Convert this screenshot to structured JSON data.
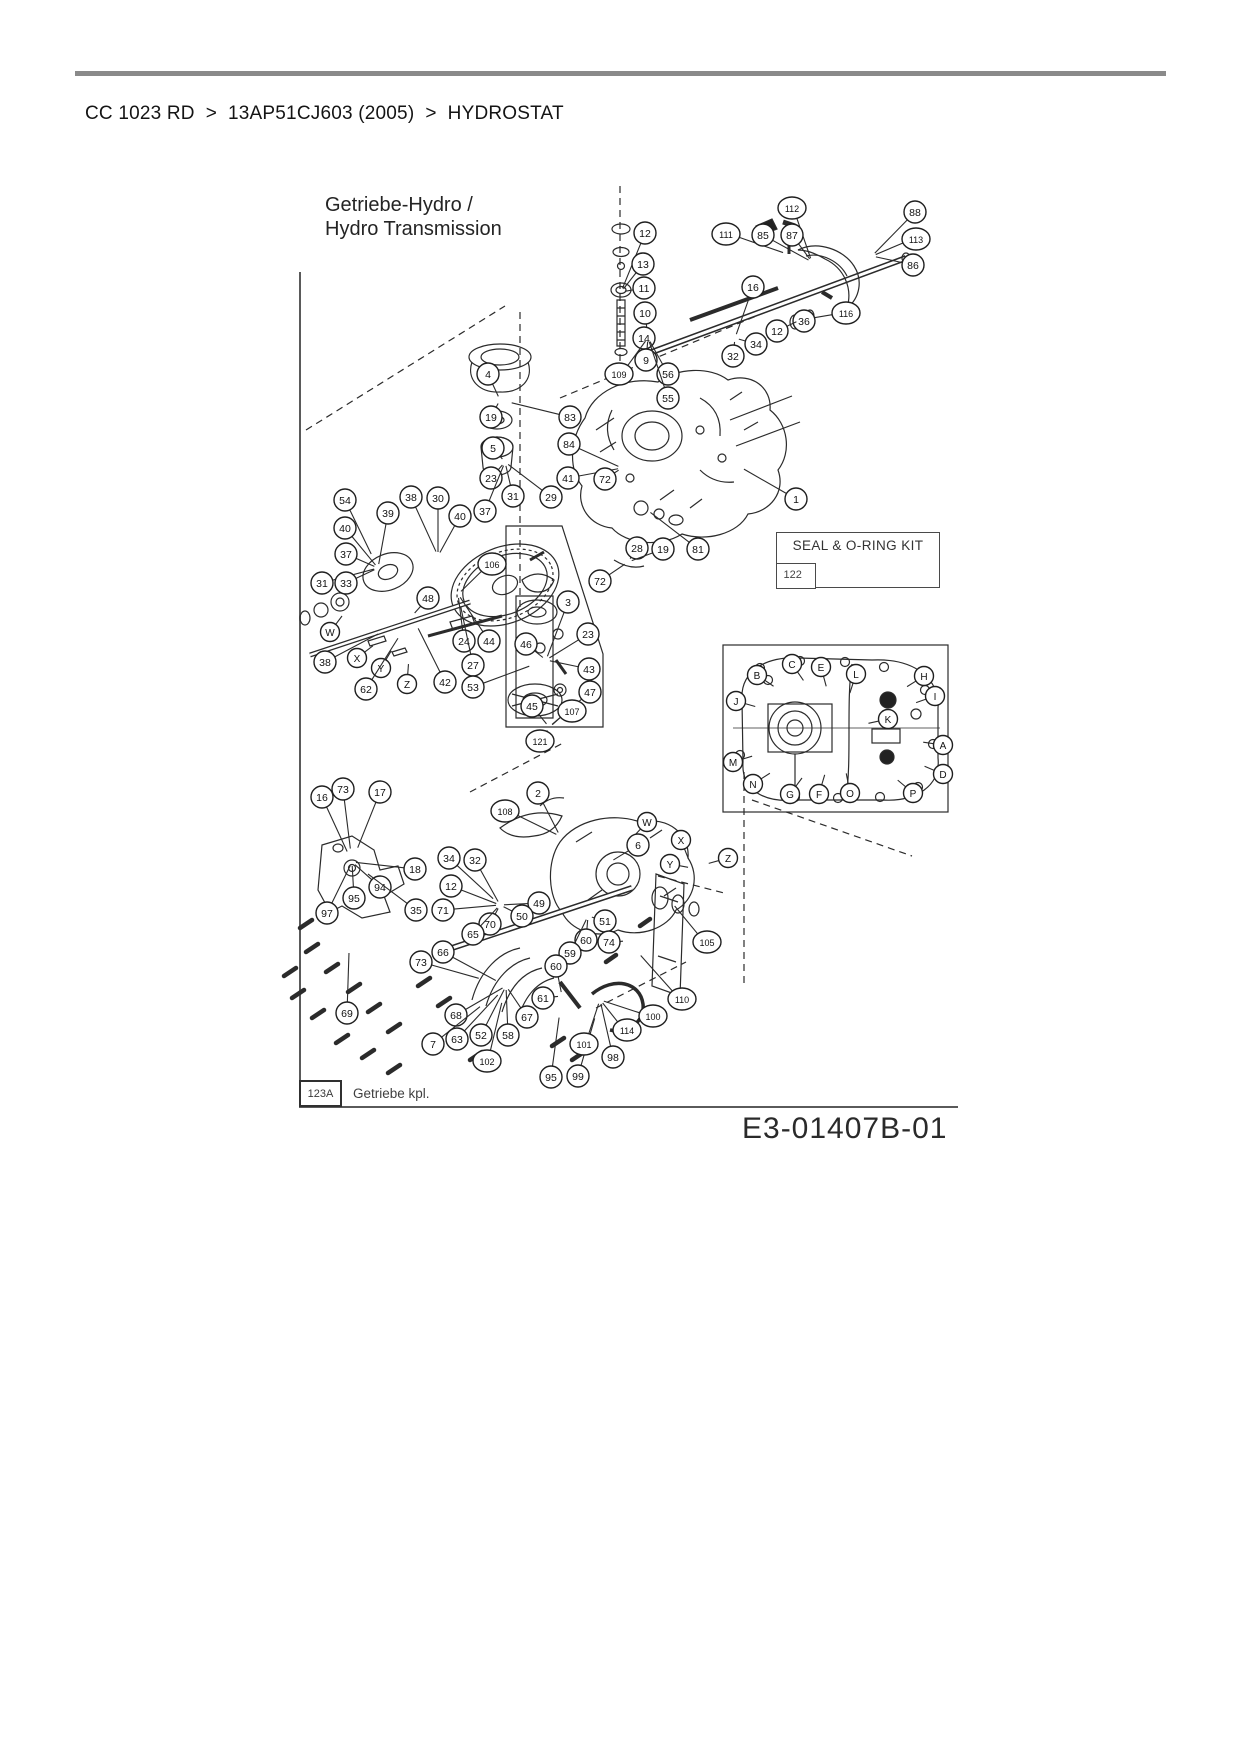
{
  "page": {
    "breadcrumb_items": [
      "CC 1023 RD",
      "13AP51CJ603 (2005)",
      "HYDROSTAT"
    ],
    "breadcrumb_separator": ">",
    "drawing_number": "E3-01407B-01"
  },
  "diagram": {
    "title_line1": "Getriebe-Hydro /",
    "title_line2": "Hydro Transmission",
    "seal_kit": {
      "label": "SEAL & O-RING KIT",
      "part": "122"
    },
    "footer": {
      "ref": "123A",
      "label": "Getriebe kpl."
    },
    "callouts": [
      {
        "label": "12",
        "x": 645,
        "y": 233
      },
      {
        "label": "13",
        "x": 643,
        "y": 264
      },
      {
        "label": "11",
        "x": 644,
        "y": 288
      },
      {
        "label": "10",
        "x": 645,
        "y": 313
      },
      {
        "label": "14",
        "x": 644,
        "y": 338
      },
      {
        "label": "9",
        "x": 646,
        "y": 360
      },
      {
        "label": "56",
        "x": 668,
        "y": 374
      },
      {
        "label": "55",
        "x": 668,
        "y": 398
      },
      {
        "label": "111",
        "x": 726,
        "y": 234
      },
      {
        "label": "85",
        "x": 763,
        "y": 235
      },
      {
        "label": "112",
        "x": 792,
        "y": 208
      },
      {
        "label": "87",
        "x": 792,
        "y": 235
      },
      {
        "label": "88",
        "x": 915,
        "y": 212
      },
      {
        "label": "113",
        "x": 916,
        "y": 239
      },
      {
        "label": "86",
        "x": 913,
        "y": 265
      },
      {
        "label": "16",
        "x": 753,
        "y": 287
      },
      {
        "label": "116",
        "x": 846,
        "y": 313
      },
      {
        "label": "36",
        "x": 804,
        "y": 321
      },
      {
        "label": "12",
        "x": 777,
        "y": 331
      },
      {
        "label": "34",
        "x": 756,
        "y": 344
      },
      {
        "label": "32",
        "x": 733,
        "y": 356
      },
      {
        "label": "4",
        "x": 488,
        "y": 374
      },
      {
        "label": "19",
        "x": 491,
        "y": 417
      },
      {
        "label": "5",
        "x": 493,
        "y": 448
      },
      {
        "label": "23",
        "x": 491,
        "y": 478
      },
      {
        "label": "109",
        "x": 619,
        "y": 374
      },
      {
        "label": "83",
        "x": 570,
        "y": 417
      },
      {
        "label": "84",
        "x": 569,
        "y": 444
      },
      {
        "label": "41",
        "x": 568,
        "y": 478
      },
      {
        "label": "72",
        "x": 605,
        "y": 479
      },
      {
        "label": "29",
        "x": 551,
        "y": 497
      },
      {
        "label": "54",
        "x": 345,
        "y": 500
      },
      {
        "label": "40",
        "x": 345,
        "y": 528
      },
      {
        "label": "37",
        "x": 346,
        "y": 554
      },
      {
        "label": "31",
        "x": 322,
        "y": 583
      },
      {
        "label": "33",
        "x": 346,
        "y": 583
      },
      {
        "label": "W",
        "x": 330,
        "y": 632
      },
      {
        "label": "38",
        "x": 325,
        "y": 662
      },
      {
        "label": "X",
        "x": 357,
        "y": 658
      },
      {
        "label": "Y",
        "x": 381,
        "y": 668
      },
      {
        "label": "Z",
        "x": 407,
        "y": 684
      },
      {
        "label": "62",
        "x": 366,
        "y": 689
      },
      {
        "label": "39",
        "x": 388,
        "y": 513
      },
      {
        "label": "38",
        "x": 411,
        "y": 497
      },
      {
        "label": "30",
        "x": 438,
        "y": 498
      },
      {
        "label": "40",
        "x": 460,
        "y": 516
      },
      {
        "label": "37",
        "x": 485,
        "y": 511
      },
      {
        "label": "31",
        "x": 513,
        "y": 496
      },
      {
        "label": "106",
        "x": 492,
        "y": 564
      },
      {
        "label": "48",
        "x": 428,
        "y": 598
      },
      {
        "label": "24",
        "x": 464,
        "y": 641
      },
      {
        "label": "44",
        "x": 489,
        "y": 641
      },
      {
        "label": "27",
        "x": 473,
        "y": 665
      },
      {
        "label": "42",
        "x": 445,
        "y": 682
      },
      {
        "label": "53",
        "x": 473,
        "y": 687
      },
      {
        "label": "46",
        "x": 526,
        "y": 644
      },
      {
        "label": "3",
        "x": 568,
        "y": 602
      },
      {
        "label": "23",
        "x": 588,
        "y": 634
      },
      {
        "label": "43",
        "x": 589,
        "y": 669
      },
      {
        "label": "47",
        "x": 590,
        "y": 692
      },
      {
        "label": "107",
        "x": 572,
        "y": 711
      },
      {
        "label": "45",
        "x": 532,
        "y": 706
      },
      {
        "label": "121",
        "x": 540,
        "y": 741
      },
      {
        "label": "72",
        "x": 600,
        "y": 581
      },
      {
        "label": "28",
        "x": 637,
        "y": 548
      },
      {
        "label": "19",
        "x": 663,
        "y": 549
      },
      {
        "label": "81",
        "x": 698,
        "y": 549
      },
      {
        "label": "1",
        "x": 796,
        "y": 499
      },
      {
        "label": "B",
        "x": 757,
        "y": 675
      },
      {
        "label": "C",
        "x": 792,
        "y": 664
      },
      {
        "label": "E",
        "x": 821,
        "y": 667
      },
      {
        "label": "L",
        "x": 856,
        "y": 674
      },
      {
        "label": "H",
        "x": 924,
        "y": 676
      },
      {
        "label": "I",
        "x": 935,
        "y": 696
      },
      {
        "label": "J",
        "x": 736,
        "y": 701
      },
      {
        "label": "K",
        "x": 888,
        "y": 719
      },
      {
        "label": "A",
        "x": 943,
        "y": 745
      },
      {
        "label": "M",
        "x": 733,
        "y": 762
      },
      {
        "label": "D",
        "x": 943,
        "y": 774
      },
      {
        "label": "N",
        "x": 753,
        "y": 784
      },
      {
        "label": "G",
        "x": 790,
        "y": 794
      },
      {
        "label": "F",
        "x": 819,
        "y": 794
      },
      {
        "label": "O",
        "x": 850,
        "y": 793
      },
      {
        "label": "P",
        "x": 913,
        "y": 793
      },
      {
        "label": "73",
        "x": 343,
        "y": 789
      },
      {
        "label": "16",
        "x": 322,
        "y": 797
      },
      {
        "label": "17",
        "x": 380,
        "y": 792
      },
      {
        "label": "18",
        "x": 415,
        "y": 869
      },
      {
        "label": "94",
        "x": 380,
        "y": 887
      },
      {
        "label": "95",
        "x": 354,
        "y": 898
      },
      {
        "label": "97",
        "x": 327,
        "y": 913
      },
      {
        "label": "2",
        "x": 538,
        "y": 793
      },
      {
        "label": "108",
        "x": 505,
        "y": 811
      },
      {
        "label": "34",
        "x": 449,
        "y": 858
      },
      {
        "label": "32",
        "x": 475,
        "y": 860
      },
      {
        "label": "12",
        "x": 451,
        "y": 886
      },
      {
        "label": "35",
        "x": 416,
        "y": 910
      },
      {
        "label": "71",
        "x": 443,
        "y": 910
      },
      {
        "label": "70",
        "x": 490,
        "y": 924
      },
      {
        "label": "65",
        "x": 473,
        "y": 934
      },
      {
        "label": "66",
        "x": 443,
        "y": 952
      },
      {
        "label": "73",
        "x": 421,
        "y": 962
      },
      {
        "label": "W",
        "x": 647,
        "y": 822
      },
      {
        "label": "6",
        "x": 638,
        "y": 845
      },
      {
        "label": "X",
        "x": 681,
        "y": 840
      },
      {
        "label": "Y",
        "x": 670,
        "y": 864
      },
      {
        "label": "Z",
        "x": 728,
        "y": 858
      },
      {
        "label": "49",
        "x": 539,
        "y": 903
      },
      {
        "label": "50",
        "x": 522,
        "y": 916
      },
      {
        "label": "51",
        "x": 605,
        "y": 921
      },
      {
        "label": "60",
        "x": 586,
        "y": 940
      },
      {
        "label": "74",
        "x": 609,
        "y": 942
      },
      {
        "label": "59",
        "x": 570,
        "y": 953
      },
      {
        "label": "60",
        "x": 556,
        "y": 966
      },
      {
        "label": "61",
        "x": 543,
        "y": 998
      },
      {
        "label": "105",
        "x": 707,
        "y": 942
      },
      {
        "label": "110",
        "x": 682,
        "y": 999
      },
      {
        "label": "69",
        "x": 347,
        "y": 1013
      },
      {
        "label": "68",
        "x": 456,
        "y": 1015
      },
      {
        "label": "7",
        "x": 433,
        "y": 1044
      },
      {
        "label": "63",
        "x": 457,
        "y": 1039
      },
      {
        "label": "52",
        "x": 481,
        "y": 1035
      },
      {
        "label": "58",
        "x": 508,
        "y": 1035
      },
      {
        "label": "102",
        "x": 487,
        "y": 1061
      },
      {
        "label": "67",
        "x": 527,
        "y": 1017
      },
      {
        "label": "95",
        "x": 551,
        "y": 1077
      },
      {
        "label": "99",
        "x": 578,
        "y": 1076
      },
      {
        "label": "101",
        "x": 584,
        "y": 1044
      },
      {
        "label": "98",
        "x": 613,
        "y": 1057
      },
      {
        "label": "114",
        "x": 627,
        "y": 1030
      },
      {
        "label": "100",
        "x": 653,
        "y": 1016
      }
    ]
  },
  "colors": {
    "top_rule": "#8a8a8a",
    "ink": "#2b2b2b",
    "background": "#ffffff"
  }
}
